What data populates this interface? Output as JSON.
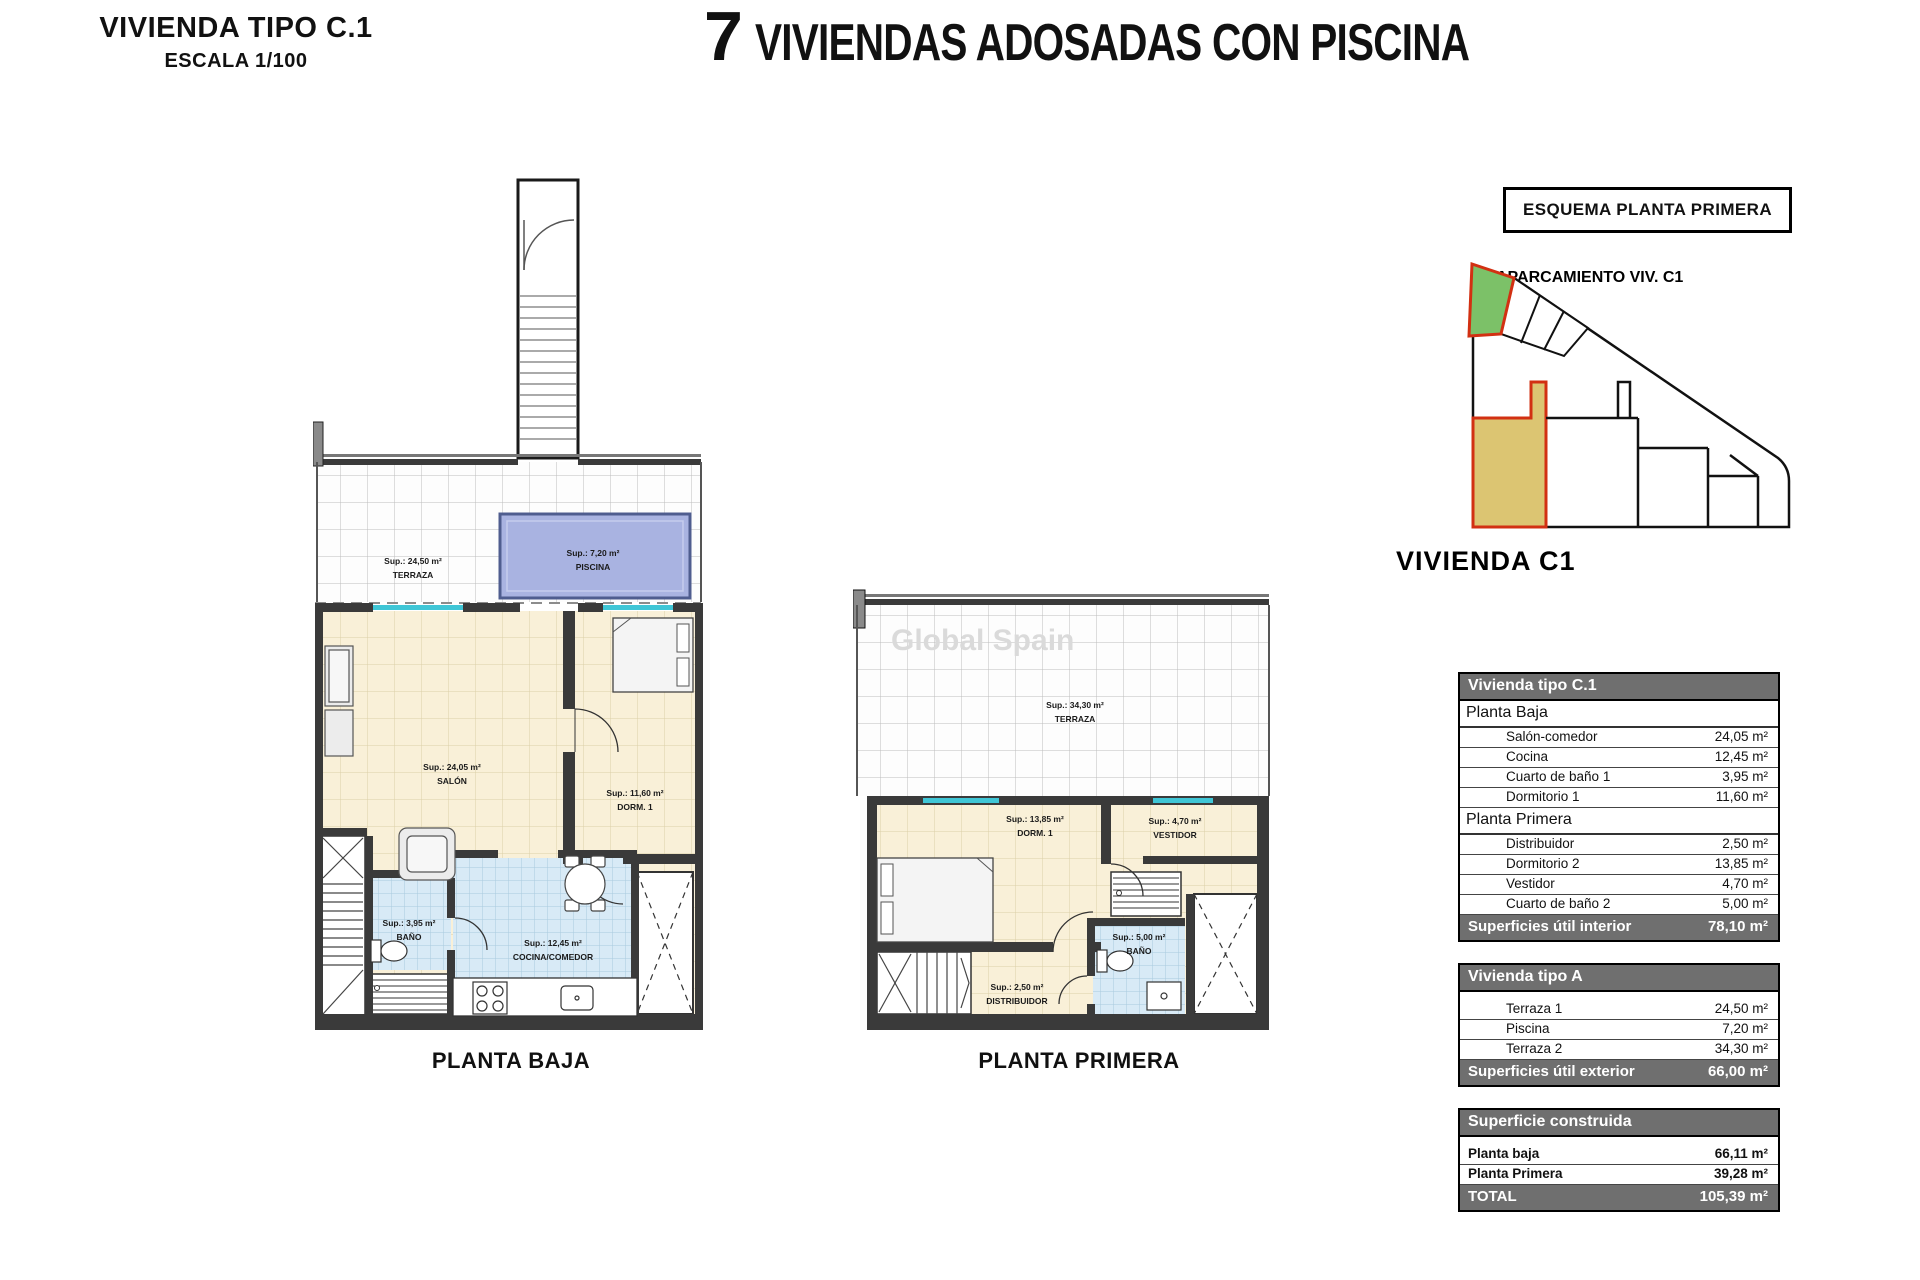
{
  "header": {
    "sheet_title": "VIVIENDA TIPO C.1",
    "sheet_scale": "ESCALA 1/100",
    "main_title_number": "7",
    "main_title_text": "VIVIENDAS ADOSADAS CON PISCINA"
  },
  "schema": {
    "box_title": "ESQUEMA PLANTA PRIMERA",
    "parking_label": "APARCAMIENTO VIV. C1",
    "unit_label": "VIVIENDA C1"
  },
  "watermark": "Global Spain",
  "plan_baja": {
    "caption": "PLANTA BAJA",
    "labels": {
      "terraza": [
        "Sup.: 24,50 m²",
        "TERRAZA"
      ],
      "piscina": [
        "Sup.: 7,20 m²",
        "PISCINA"
      ],
      "salon": [
        "Sup.: 24,05 m²",
        "SALÓN"
      ],
      "dorm1": [
        "Sup.: 11,60 m²",
        "DORM. 1"
      ],
      "bano": [
        "Sup.: 3,95 m²",
        "BAÑO"
      ],
      "cocina": [
        "Sup.: 12,45 m²",
        "COCINA/COMEDOR"
      ]
    }
  },
  "plan_primera": {
    "caption": "PLANTA PRIMERA",
    "labels": {
      "terraza": [
        "Sup.: 34,30 m²",
        "TERRAZA"
      ],
      "dorm": [
        "Sup.: 13,85 m²",
        "DORM. 1"
      ],
      "vestidor": [
        "Sup.: 4,70 m²",
        "VESTIDOR"
      ],
      "distribuidor": [
        "Sup.: 2,50 m²",
        "DISTRIBUIDOR"
      ],
      "bano": [
        "Sup.: 5,00 m²",
        "BAÑO"
      ]
    }
  },
  "tables": [
    {
      "title": "Vivienda tipo C.1",
      "sections": [
        {
          "name": "Planta Baja",
          "rows": [
            [
              "Salón-comedor",
              "24,05 m²"
            ],
            [
              "Cocina",
              "12,45 m²"
            ],
            [
              "Cuarto de baño 1",
              "3,95 m²"
            ],
            [
              "Dormitorio 1",
              "11,60 m²"
            ]
          ]
        },
        {
          "name": "Planta Primera",
          "rows": [
            [
              "Distribuidor",
              "2,50 m²"
            ],
            [
              "Dormitorio 2",
              "13,85 m²"
            ],
            [
              "Vestidor",
              "4,70 m²"
            ],
            [
              "Cuarto de baño 2",
              "5,00 m²"
            ]
          ]
        }
      ],
      "footer": [
        "Superficies útil interior",
        "78,10 m²"
      ]
    },
    {
      "title": "Vivienda tipo A",
      "rows": [
        [
          "Terraza 1",
          "24,50 m²"
        ],
        [
          "Piscina",
          "7,20 m²"
        ],
        [
          "Terraza 2",
          "34,30 m²"
        ]
      ],
      "footer": [
        "Superficies útil exterior",
        "66,00 m²"
      ]
    },
    {
      "title": "Superficie construida",
      "rows": [
        [
          "Planta baja",
          "66,11 m²"
        ],
        [
          "Planta Primera",
          "39,28 m²"
        ]
      ],
      "footer": [
        "TOTAL",
        "105,39 m²"
      ]
    }
  ],
  "colors": {
    "table_header": "#6f6f6f",
    "pool": "#a9b3e1",
    "floor_cream": "#f9f0d8",
    "tile_blue": "#d8eaf6",
    "wall": "#3a3a3a",
    "highlight_red": "#d23012",
    "parking_green": "#7cc168",
    "unit_tan": "#dcc572",
    "glass_cyan": "#3fc6d6"
  }
}
